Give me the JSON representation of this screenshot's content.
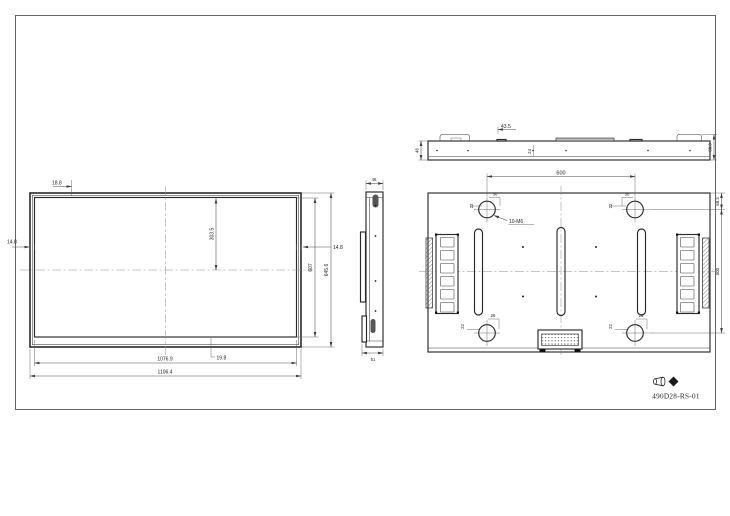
{
  "front": {
    "bezel_top": "18.8",
    "bezel_left": "14.8",
    "bezel_right": "14.8",
    "bezel_bottom": "19.8",
    "center_height": "303.5",
    "active_height": "607",
    "overall_height": "645.6",
    "active_width": "1076.9",
    "overall_width": "1106.4"
  },
  "side": {
    "depth_top": "46",
    "depth_bottom": "51"
  },
  "top": {
    "depth_left": "46",
    "bracket_offset": "43.5",
    "tab": "24",
    "overall_depth": "68.3"
  },
  "back": {
    "vesa_width": "600",
    "vesa_height": "500",
    "edge_to_hole": "68.3",
    "hole_callout": "10-M6",
    "hole_offset": "22",
    "hole_to_slot_top": "30",
    "hole_to_slot_bottom": "26"
  },
  "title_block": {
    "drawing_number": "490D28-RS-01"
  }
}
